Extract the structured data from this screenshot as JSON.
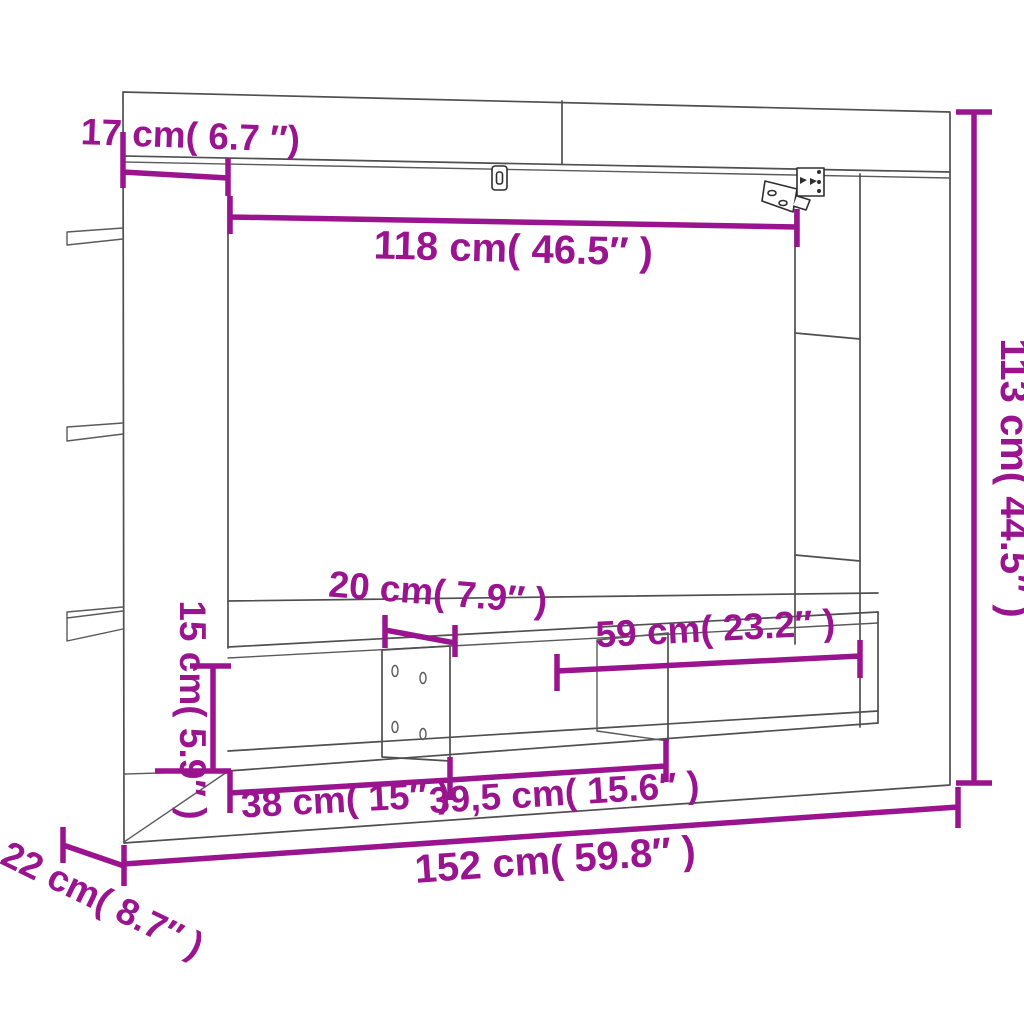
{
  "diagram": {
    "title": "TV wall cabinet dimension diagram",
    "colors": {
      "dimension_accent": "#9b148f",
      "outline": "#4f4f4f",
      "background": "#ffffff"
    },
    "icons": [
      "keyhole-hanger-icon",
      "wall-bracket-icon"
    ],
    "labels": {
      "top_offset": "17 cm( 6.7 ″)",
      "inner_width": "118 cm( 46.5″ )",
      "overall_height": "113 cm( 44.5″ )",
      "divider_width": "20 cm( 7.9″ )",
      "right_shelf_width": "59 cm( 23.2″ )",
      "compartment_height": "15 cm( 5.9″ )",
      "left_compartment_width": "38 cm( 15″ )",
      "center_compartment_width": "39,5 cm( 15.6″ )",
      "overall_width": "152 cm( 59.8″ )",
      "depth": "22 cm( 8.7″ )"
    }
  }
}
